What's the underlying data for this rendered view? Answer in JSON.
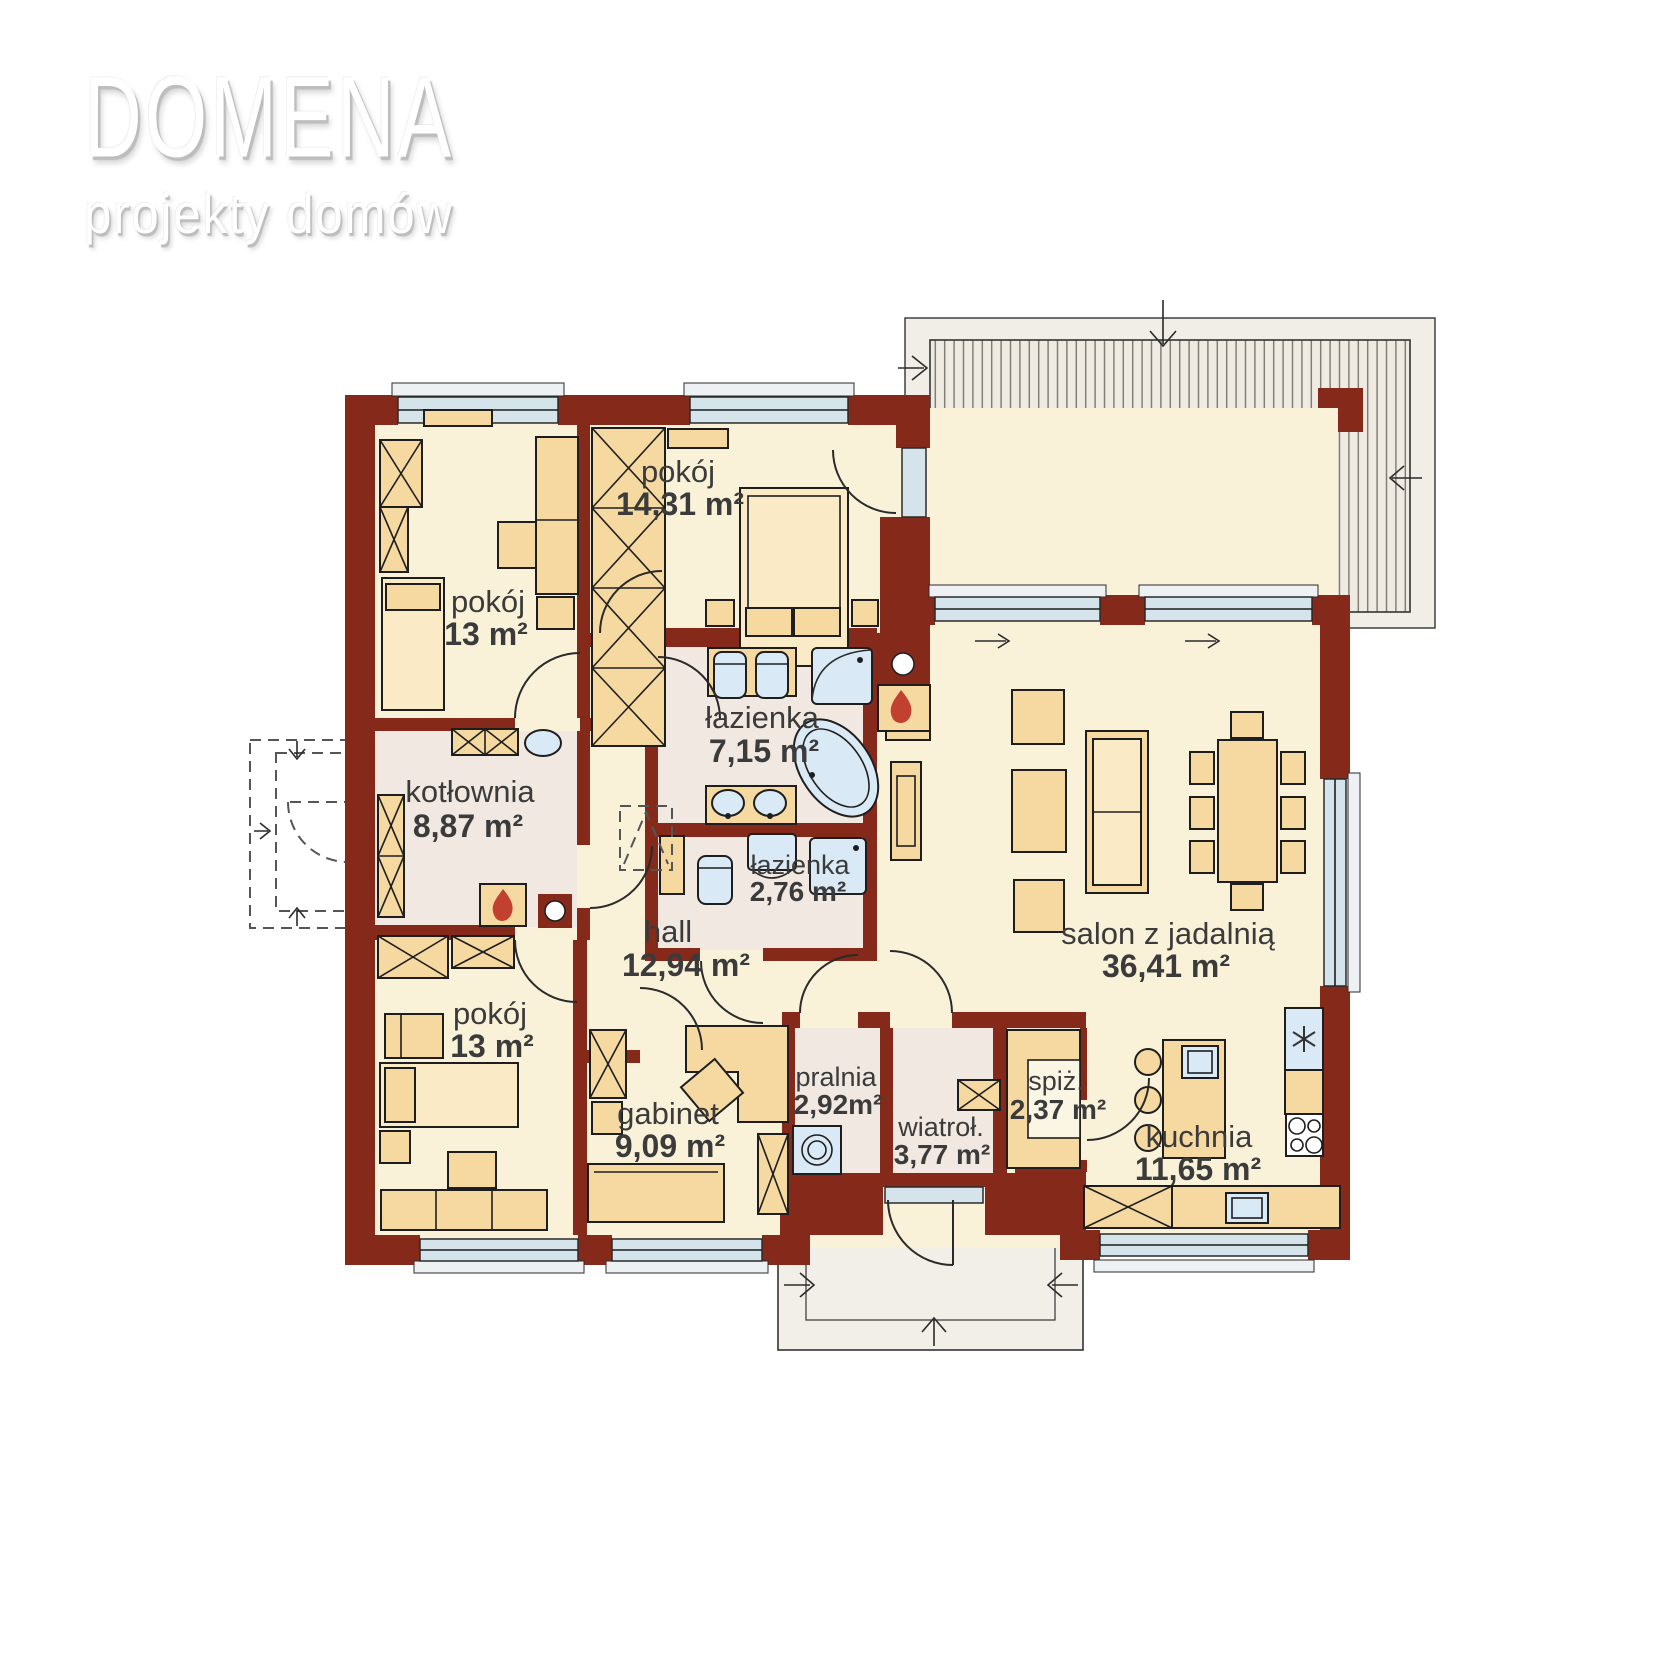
{
  "brand": {
    "name": "DOMENA",
    "tagline": "projekty domów"
  },
  "plan": {
    "rooms": [
      {
        "id": "pokoj-1",
        "name": "pokój",
        "area": "14,31 m²"
      },
      {
        "id": "pokoj-2",
        "name": "pokój",
        "area": "13 m²"
      },
      {
        "id": "kotlownia",
        "name": "kotłownia",
        "area": "8,87 m²"
      },
      {
        "id": "lazienka-1",
        "name": "łazienka",
        "area": "7,15 m²"
      },
      {
        "id": "lazienka-2",
        "name": "łazienka",
        "area": "2,76 m²"
      },
      {
        "id": "hall",
        "name": "hall",
        "area": "12,94 m²"
      },
      {
        "id": "pokoj-3",
        "name": "pokój",
        "area": "13 m²"
      },
      {
        "id": "gabinet",
        "name": "gabinet",
        "area": "9,09 m²"
      },
      {
        "id": "pralnia",
        "name": "pralnia",
        "area": "2,92m²"
      },
      {
        "id": "wiatrolap",
        "name": "wiatroł.",
        "area": "3,77 m²"
      },
      {
        "id": "spizarnia",
        "name": "spiż.",
        "area": "2,37 m²"
      },
      {
        "id": "kuchnia",
        "name": "kuchnia",
        "area": "11,65 m²"
      },
      {
        "id": "salon",
        "name": "salon z jadalnią",
        "area": "36,41 m²"
      }
    ],
    "icons": [
      "flame-icon",
      "chimney-icon",
      "washer-icon",
      "fridge-icon",
      "cooktop-icon",
      "sink-icon",
      "shower-icon",
      "bathtub-icon",
      "toilet-icon",
      "bidet-icon",
      "drain-icon"
    ],
    "colors": {
      "wall": "#85291B",
      "floor": "#FAF2D8",
      "wet_floor": "#F1E9E1",
      "furniture": "#F5D9A1",
      "fixture": "#D9EAF6",
      "window": "#D5E3EB",
      "deck": "#EFEBE3",
      "flame": "#C2402F",
      "label": "#3B3B3B"
    }
  }
}
